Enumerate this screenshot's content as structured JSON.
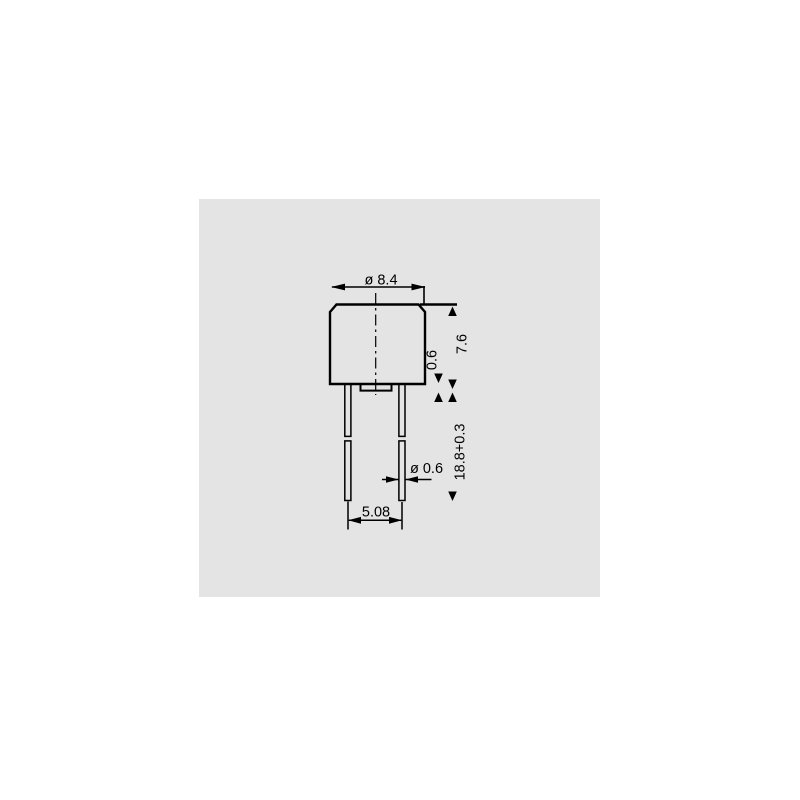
{
  "colors": {
    "page_background": "#ffffff",
    "panel_background": "#e4e4e4",
    "line": "#000000"
  },
  "dimensions": [
    {
      "id": "body-diameter",
      "label": "ø 8.4"
    },
    {
      "id": "step-height",
      "label": "0.6"
    },
    {
      "id": "body-height",
      "label": "7.6"
    },
    {
      "id": "lead-length",
      "label": "18.8+0.3"
    },
    {
      "id": "lead-diameter",
      "label": "ø 0.6"
    },
    {
      "id": "lead-pitch",
      "label": "5.08"
    }
  ]
}
